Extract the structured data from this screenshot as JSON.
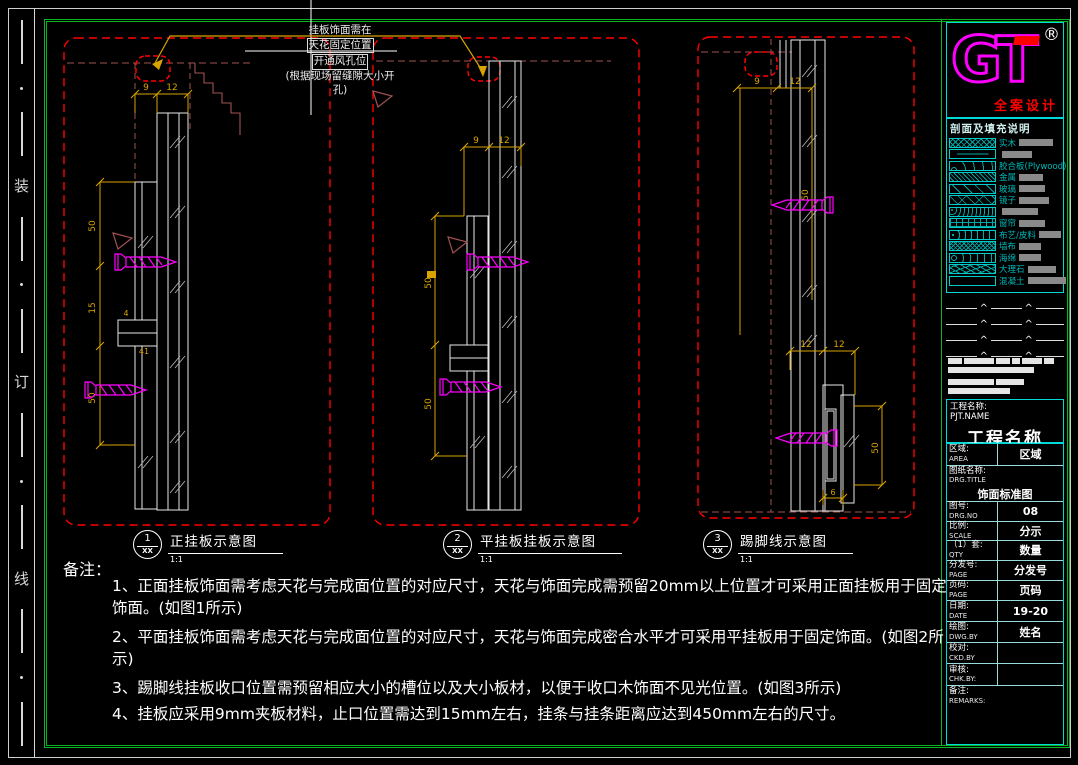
{
  "page": {
    "title": "挂板饰面标准图"
  },
  "colors": {
    "frame_green": "#0ab523",
    "detail_border_red": "#ff0000",
    "dim_yellow": "#d9a300",
    "screw_magenta": "#ff00ff",
    "legend_cyan": "#00b8b8",
    "logo_magenta": "#ff00ff",
    "accent_red": "#ff0000",
    "hidden_line_brown": "#a05252"
  },
  "binding_strip": {
    "chars": [
      "装",
      "订",
      "线"
    ]
  },
  "annotation": {
    "lines": [
      "挂板饰面需在",
      "天花固定位置",
      "开通风孔位",
      "(根据现场留缝隙大小开",
      "孔)"
    ]
  },
  "figures": [
    {
      "num": "1",
      "ref": "XX",
      "title": "正挂板示意图",
      "scale": "1:1",
      "dims": {
        "top_a": "9",
        "top_b": "12",
        "left_a": "50",
        "left_b": "15",
        "left_c": "50",
        "notch_a": "4",
        "notch_b": "41"
      }
    },
    {
      "num": "2",
      "ref": "XX",
      "title": "平挂板挂板示意图",
      "scale": "1:1",
      "dims": {
        "top_a": "9",
        "top_b": "12",
        "left_a": "50",
        "left_b": "50"
      }
    },
    {
      "num": "3",
      "ref": "XX",
      "title": "踢脚线示意图",
      "scale": "1:1",
      "dims": {
        "top_a": "9",
        "top_b": "12",
        "mid_a": "12",
        "mid_b": "12",
        "right_a": "50",
        "skirt_h": "50",
        "skirt_w": "6"
      }
    }
  ],
  "notes": {
    "header": "备注：",
    "items": [
      "1、正面挂板饰面需考虑天花与完成面位置的对应尺寸，天花与饰面完成需预留20mm以上位置才可采用正面挂板用于固定饰面。(如图1所示)",
      "2、平面挂板饰面需考虑天花与完成面位置的对应尺寸，天花与饰面完成密合水平才可采用平挂板用于固定饰面。(如图2所示)",
      "3、踢脚线挂板收口位置需预留相应大小的槽位以及大小板材，以便于收口木饰面不见光位置。(如图3所示)",
      "4、挂板应采用9mm夹板材料，止口位置需达到15mm左右，挂条与挂条距离应达到450mm左右的尺寸。"
    ]
  },
  "titleblock": {
    "logo": {
      "text": "GT",
      "reg": "®",
      "tagline": "全案设计"
    },
    "caret": "^",
    "legend": {
      "header": "剖面及填充说明",
      "items": [
        {
          "label": "实木"
        },
        {
          "label": ""
        },
        {
          "label": "胶合板(Plywood)"
        },
        {
          "label": "金属"
        },
        {
          "label": "玻璃"
        },
        {
          "label": "镜子"
        },
        {
          "label": ""
        },
        {
          "label": "窗帘"
        },
        {
          "label": "布艺/皮料"
        },
        {
          "label": "墙布"
        },
        {
          "label": "海绵"
        },
        {
          "label": "大理石"
        },
        {
          "label": "混凝土"
        }
      ]
    },
    "project": {
      "label": "工程名称:",
      "label_en": "PJT.NAME",
      "value": "工程名称"
    },
    "rows": [
      {
        "label": "区域:",
        "en": "AREA",
        "value": "区域"
      },
      {
        "label": "图纸名称:",
        "en": "DRG.TITLE",
        "value": "饰面标准图"
      },
      {
        "label": "图号:",
        "en": "DRG.NO",
        "value": "08"
      },
      {
        "label": "比例:",
        "en": "SCALE",
        "value": "分示"
      },
      {
        "label": "（1）套:",
        "en": "QTY",
        "value": "数量"
      },
      {
        "label": "分发号:",
        "en": "PAGE",
        "value": "分发号"
      },
      {
        "label": "页码:",
        "en": "PAGE",
        "value": "页码"
      },
      {
        "label": "日期:",
        "en": "DATE",
        "value": "19-20"
      },
      {
        "label": "绘图:",
        "en": "DWG.BY",
        "value": "姓名"
      },
      {
        "label": "校对:",
        "en": "CKD.BY",
        "value": ""
      },
      {
        "label": "审核:",
        "en": "CHK.BY:",
        "value": ""
      },
      {
        "label": "备注:",
        "en": "REMARKS:",
        "value": ""
      }
    ]
  }
}
